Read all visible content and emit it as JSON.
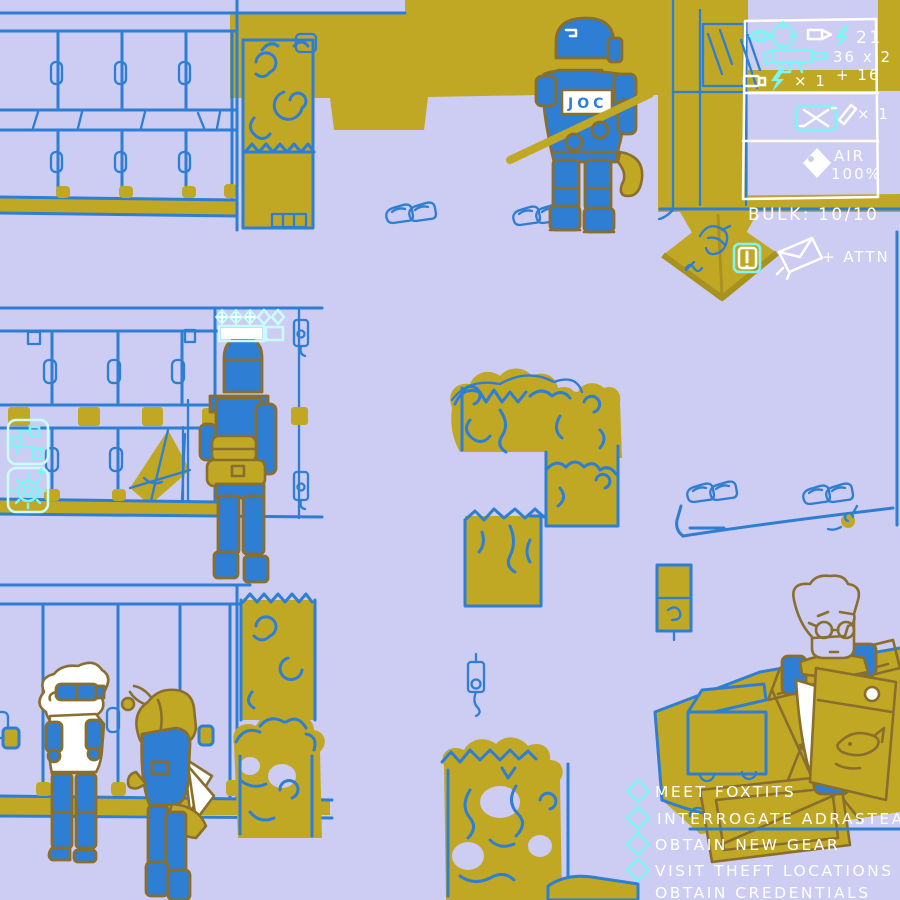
{
  "hud": {
    "weapons": {
      "ammo_count": "21",
      "magazine": "36 x 2",
      "reserve": "+ 16",
      "shell_qty": "× 1"
    },
    "items": {
      "qty": "× 1"
    },
    "air": {
      "label": "AIR",
      "value": "100%"
    },
    "bulk": {
      "label": "BULK:",
      "value": "10/10"
    },
    "attn": {
      "label": "+ ATTN"
    }
  },
  "player_status": {
    "charges_filled": 3,
    "charges_total": 5,
    "health_fill_ratio": 0.7
  },
  "npcs": {
    "cop_vest_sign": "JOC"
  },
  "package": {
    "alert": "!"
  },
  "quests": {
    "items": [
      {
        "label": "MEET FOXTITS",
        "has_marker": true
      },
      {
        "label": "INTERROGATE ADRASTEA",
        "has_marker": true
      },
      {
        "label": "OBTAIN NEW GEAR",
        "has_marker": true
      },
      {
        "label": "VISIT THEFT LOCATIONS 2/2",
        "has_marker": true
      },
      {
        "label": "OBTAIN CREDENTIALS",
        "has_marker": false
      }
    ]
  },
  "colors": {
    "background": "#cdccf3",
    "olive": "#c0a825",
    "blue": "#2e7ed3",
    "outline_brown": "#8a6e2d",
    "cyan": "#7df5f5",
    "white": "#ffffff"
  }
}
